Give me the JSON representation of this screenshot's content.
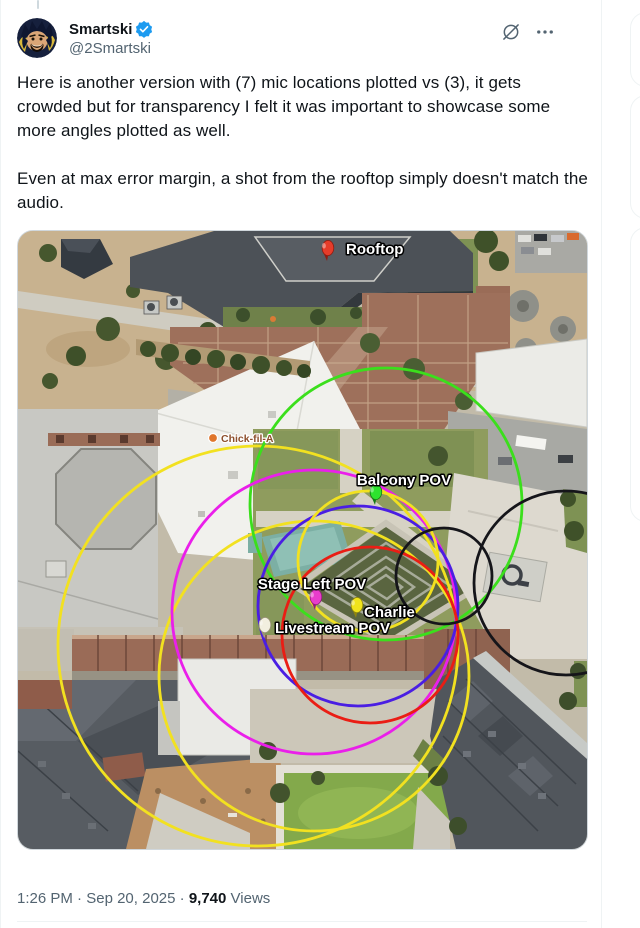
{
  "tweet": {
    "author": {
      "display_name": "Smartski",
      "handle": "@2Smartski",
      "verified": true
    },
    "body_paragraph1": "Here is another version with (7) mic locations plotted vs (3), it gets crowded but for transparency I felt it was important to showcase some more angles plotted as well.",
    "body_paragraph2": "Even at max error margin, a shot from the rooftop simply doesn't match the audio."
  },
  "icons": {
    "verified_badge": "verified-badge-icon",
    "grok": "grok-actions-icon",
    "more": "ellipsis-icon"
  },
  "colors": {
    "accent_blue": "#1d9bf0",
    "text_primary": "#0f1419",
    "text_secondary": "#536471",
    "border": "#eff3f4"
  },
  "footer": {
    "time": "1:26 PM",
    "separator": "·",
    "date": "Sep 20, 2025",
    "views_value": "9,740",
    "views_label": "Views"
  },
  "map": {
    "circle_stroke_width": 2.8,
    "circles": [
      {
        "name": "yellow-large",
        "color": "#f2e120",
        "cx": 240,
        "cy": 415,
        "r": 200
      },
      {
        "name": "yellow-mid",
        "color": "#f2e120",
        "cx": 296,
        "cy": 445,
        "r": 155
      },
      {
        "name": "green",
        "color": "#3bdf1c",
        "cx": 368,
        "cy": 273,
        "r": 136
      },
      {
        "name": "magenta",
        "color": "#ea1fea",
        "cx": 296,
        "cy": 381,
        "r": 142
      },
      {
        "name": "blue",
        "color": "#4a1ee3",
        "cx": 340,
        "cy": 375,
        "r": 100
      },
      {
        "name": "red",
        "color": "#ea1d14",
        "cx": 352,
        "cy": 404,
        "r": 88
      },
      {
        "name": "yellow-small",
        "color": "#f2e120",
        "cx": 350,
        "cy": 330,
        "r": 70
      },
      {
        "name": "black-small",
        "color": "#15151a",
        "cx": 426,
        "cy": 345,
        "r": 48
      },
      {
        "name": "black-large",
        "color": "#15151a",
        "cx": 548,
        "cy": 352,
        "r": 92
      }
    ],
    "pins": [
      {
        "label": "Rooftop",
        "color": "#e63c2a",
        "dark": "#8f1d12",
        "x": 309,
        "y": 30,
        "lx": 328,
        "ly": 23,
        "anchor": "start"
      },
      {
        "label": "Balcony POV",
        "color": "#2ee32e",
        "dark": "#157a15",
        "x": 357,
        "y": 274,
        "lx": 386,
        "ly": 254,
        "anchor": "middle"
      },
      {
        "label": "Stage Left POV",
        "color": "#e93ccc",
        "dark": "#8f1d78",
        "x": 297,
        "y": 379,
        "lx": 294,
        "ly": 358,
        "anchor": "middle"
      },
      {
        "label": "Charlie",
        "color": "#f0e31c",
        "dark": "#8f860f",
        "x": 338,
        "y": 387,
        "lx": 346,
        "ly": 386,
        "anchor": "start"
      },
      {
        "label": "Livestream POV",
        "color": "#f2efdf",
        "dark": "#9a9377",
        "x": 246,
        "y": 407,
        "lx": 257,
        "ly": 402,
        "anchor": "start"
      }
    ],
    "poi": {
      "label": "Chick-fil-A",
      "color": "#e0762c",
      "text_color": "#8d4f2c",
      "x": 195,
      "y": 207,
      "lx": 203,
      "ly": 211
    }
  }
}
